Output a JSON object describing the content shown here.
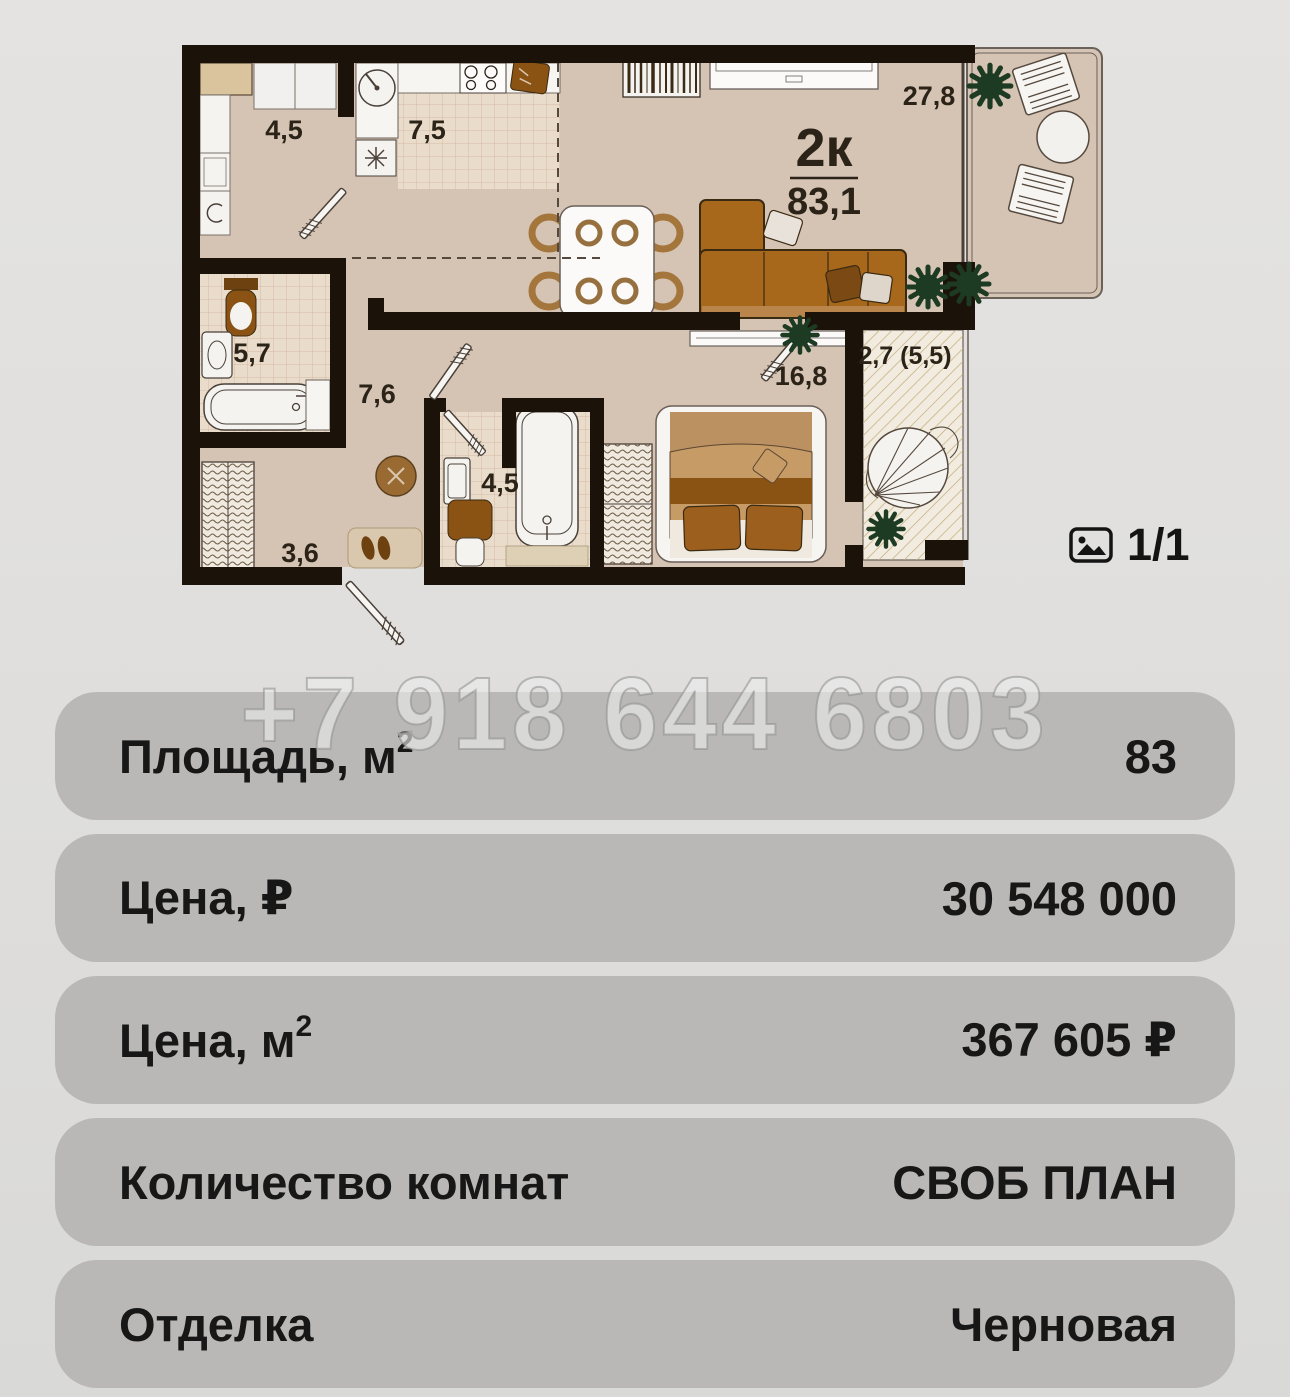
{
  "watermark": "+7 918 644 6803",
  "floorplan": {
    "plan_title": "2к",
    "total_area": "83,1",
    "counter": "1/1",
    "rooms": [
      {
        "id": "hallway-laundry",
        "area": "4,5"
      },
      {
        "id": "kitchen",
        "area": "7,5"
      },
      {
        "id": "living-kitchen",
        "area": "27,8"
      },
      {
        "id": "bathroom",
        "area": "5,7"
      },
      {
        "id": "corridor",
        "area": "7,6"
      },
      {
        "id": "hallway",
        "area": "3,6"
      },
      {
        "id": "bathroom-2",
        "area": "4,5"
      },
      {
        "id": "bedroom",
        "area": "16,8"
      },
      {
        "id": "balcony",
        "area": "2,7 (5,5)"
      }
    ]
  },
  "details": {
    "rows": [
      {
        "label": "Площадь, м",
        "sup": "2",
        "value": "83"
      },
      {
        "label": "Цена, ₽",
        "value": "30 548 000"
      },
      {
        "label": "Цена, м",
        "sup": "2",
        "value": "367 605 ₽"
      },
      {
        "label": "Количество комнат",
        "value": "СВОБ ПЛАН"
      },
      {
        "label": "Отделка",
        "value": "Черновая"
      }
    ]
  },
  "colors": {
    "page_bg": "#e0dfdd",
    "row_bg": "#b9b8b6",
    "text": "#171717",
    "wall": "#1b1309",
    "floor": "#d5c3b4",
    "tile": "#e9dccb",
    "balcony_hatch_bg": "#f1ecdf",
    "plant": "#1d3a22",
    "wood": "#8a5313",
    "sofa": "#a8681c",
    "watermark": "#ececec"
  }
}
